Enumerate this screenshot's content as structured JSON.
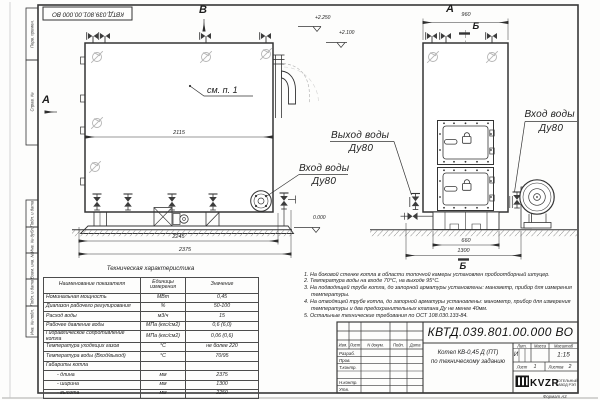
{
  "frame": {
    "stamp_top": "КВТД.039.801.00.000 ВО",
    "side_labels": [
      "Перв. примен.",
      "Справ. №",
      "Подп. и дата",
      "Инв. № дубл.",
      "Взам. инв. №",
      "Подп. и дата",
      "Инв. № подл."
    ],
    "format_label": "Формат А3"
  },
  "drawing": {
    "view_b": "В",
    "view_a_side": "А",
    "view_a_top": "А",
    "dim_a_width": "960",
    "section_b_top": "Б",
    "section_b_bottom": "Б",
    "see_item": "см. п. 1",
    "elev_top": "+2.250",
    "elev_mid": "+2.100",
    "elev_zero": "0.000",
    "dim_2115": "2115",
    "dim_2245": "2245",
    "dim_2375": "2375",
    "dim_660": "660",
    "dim_1300": "1300",
    "callout_outlet_line1": "Выход воды",
    "callout_outlet_line2": "Ду80",
    "callout_inlet_left_line1": "Вход воды",
    "callout_inlet_left_line2": "Ду80",
    "callout_inlet_right_line1": "Вход воды",
    "callout_inlet_right_line2": "Ду80"
  },
  "tech_table": {
    "title": "Техническая характеристика",
    "col_name": "Наименование показателя",
    "col_units": "Единицы измерения",
    "col_value": "Значение",
    "rows": [
      {
        "name": "Номинальная мощность",
        "units": "МВт",
        "value": "0,45"
      },
      {
        "name": "Диапазон рабочего регулирования",
        "units": "%",
        "value": "50-100"
      },
      {
        "name": "Расход воды",
        "units": "м3/ч",
        "value": "15"
      },
      {
        "name": "Рабочее давление воды",
        "units": "МПа (кгс/см2)",
        "value": "0,6 (6,0)"
      },
      {
        "name": "Гидравлическое сопротивление котла",
        "units": "МПа (кгс/см2)",
        "value": "0,06 (0,6)"
      },
      {
        "name": "Температура уходящих газов",
        "units": "°С",
        "value": "не более 220"
      },
      {
        "name": "Температура воды (Вход/выход)",
        "units": "°С",
        "value": "70/95"
      },
      {
        "name": "Габариты котла",
        "units": "",
        "value": ""
      },
      {
        "name": "- длина",
        "units": "мм",
        "value": "2375"
      },
      {
        "name": "- ширина",
        "units": "мм",
        "value": "1300"
      },
      {
        "name": "- высота",
        "units": "мм",
        "value": "2250"
      }
    ]
  },
  "notes": [
    "1. На боковой стенке котла в области топочной камеры установлен пробоотборный штуцер.",
    "2. Температура воды на входе 70°С, на выходе 95°С.",
    "3. На подводящей трубе котла, до запорной арматуры установлены: манометр, прибор для измерения температуры.",
    "4. На отводящей трубе котла, до запорной арматуры установлены: манометр, прибор для измерения температуры и два предохранительных клапана Ду не менее 40мм.",
    "5. Остальные технические требования по ОСТ 108.030.133-84."
  ],
  "title_block": {
    "designation": "КВТД.039.801.00.000 ВО",
    "doc_name_line1": "Котел КВ-0,45 Д (ПТ)",
    "doc_name_line2": "по техническому заданию",
    "rev_headers": [
      "Изм.",
      "Лист",
      "N докум.",
      "Подп.",
      "Дата"
    ],
    "sig_labels": [
      "Разраб.",
      "Пров.",
      "Т.контр.",
      "Н.контр.",
      "Утв."
    ],
    "lit_header": "Лит.",
    "mass_header": "Масса",
    "scale_header": "Масштаб",
    "lit_value": "И",
    "scale_value": "1:15",
    "sheet_label": "Лист",
    "sheet_value": "1",
    "sheets_label": "Листов",
    "sheets_value": "2",
    "company_logo": "KVZR",
    "company_line1": "КОТЕЛЬНЫЙ",
    "company_line2": "ЗАВОД РЭП"
  }
}
